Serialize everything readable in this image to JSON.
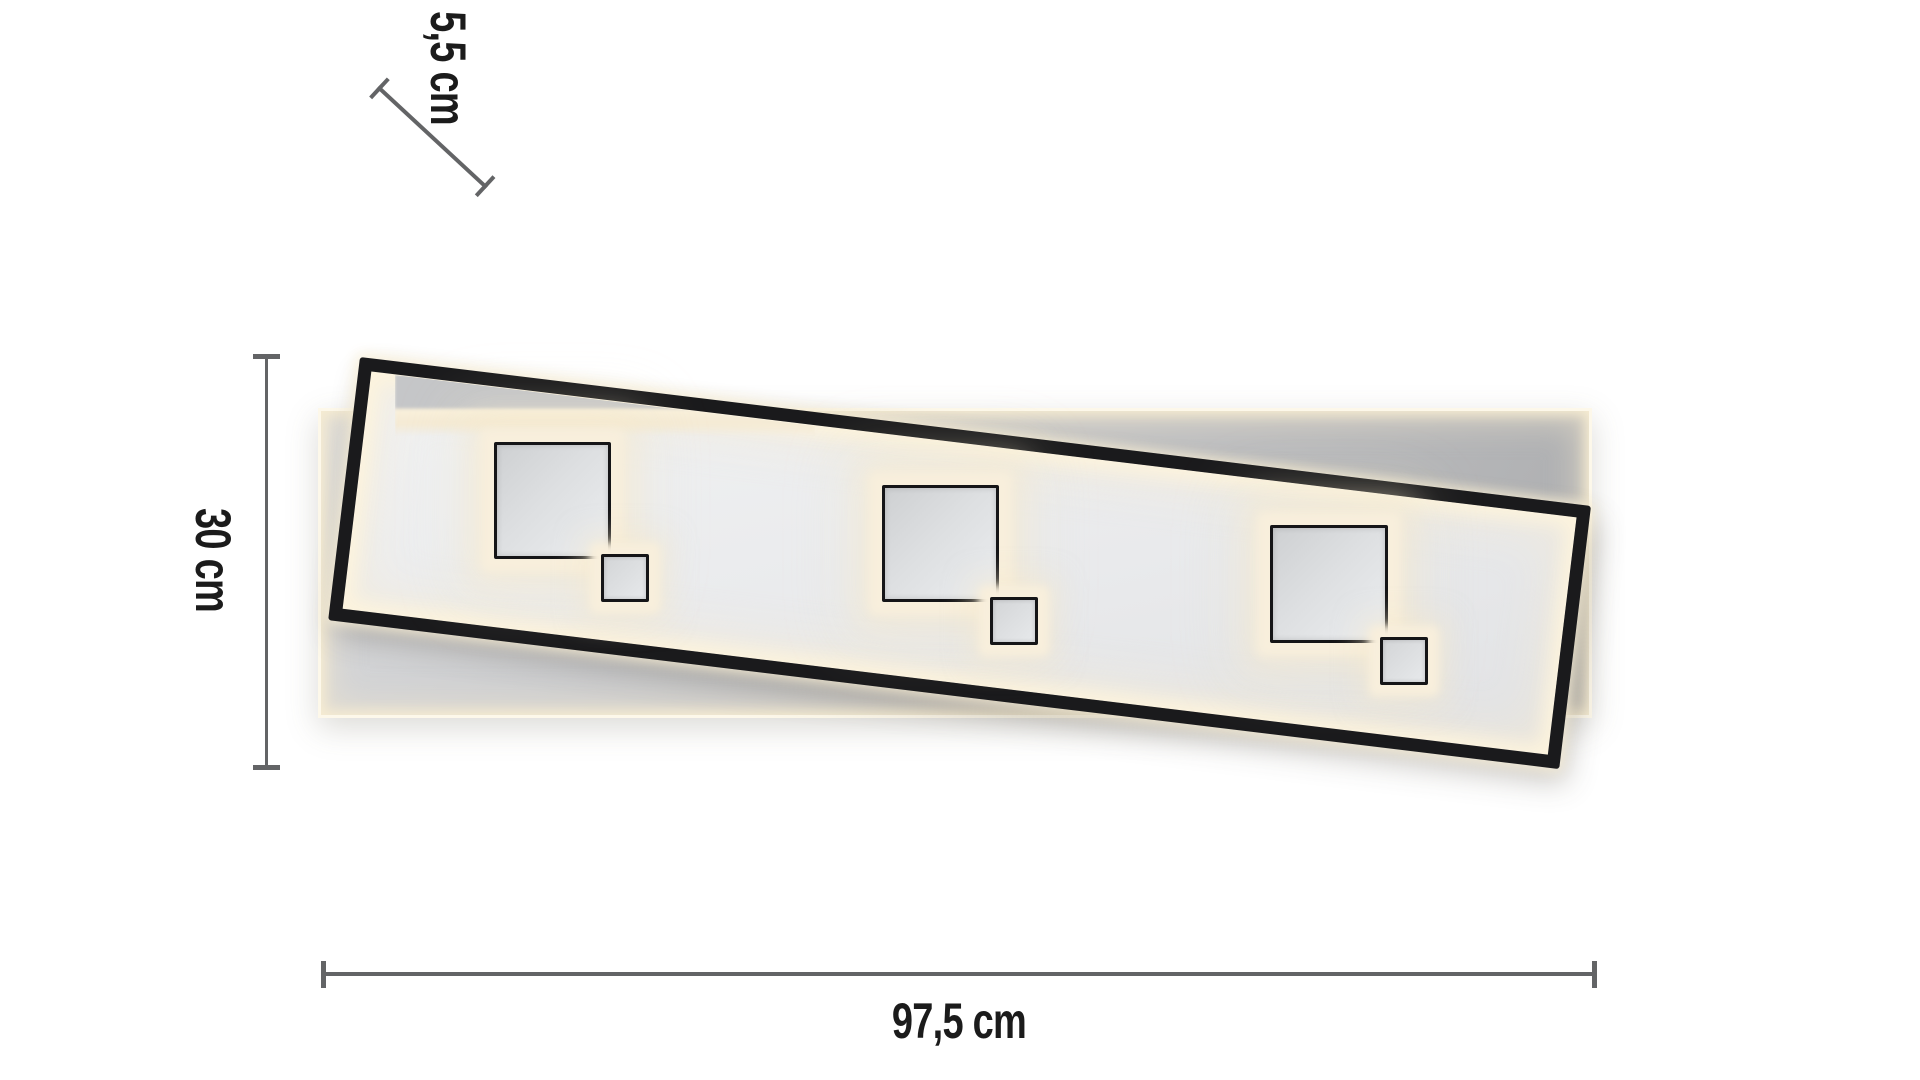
{
  "diagram": {
    "title": "LED ceiling light dimension diagram",
    "dimensions": {
      "width": {
        "label": "97,5 cm"
      },
      "height": {
        "label": "30 cm"
      },
      "depth": {
        "label": "5,5 cm"
      }
    },
    "parts": {
      "frame": "tilted black LED frame with warm white edge light",
      "backplate": "rectangular back panel with warm white rim light",
      "modules": "three pairs of square LED elements (large + small)"
    }
  },
  "colors": {
    "background": "#ffffff",
    "frame_black": "#1a1a1c",
    "glow_warm": "#f7eed8",
    "backplate_gray": "#c4c5c7",
    "square_fill_gray": "#dddfe1",
    "dimension_line_gray": "#636466",
    "label_text": "#1b1b1b"
  }
}
